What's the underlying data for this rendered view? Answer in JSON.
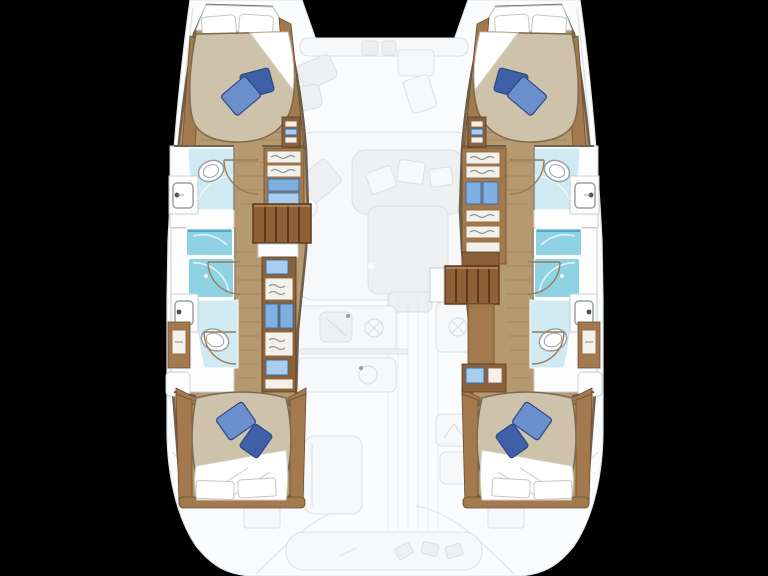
{
  "scene": {
    "description": "Top-down floor plan of a four-cabin sailing catamaran; the two hull interiors are drawn in full colour while the central bridgedeck, foredeck and cockpit are shown faded",
    "background": "#000000",
    "cabins": 4,
    "bathrooms": 4
  },
  "colors": {
    "background": "#000000",
    "deck": "#fbfcfd",
    "deck_line": "#e2e5e8",
    "faded": "#edeff1",
    "faded_stroke": "#dcdfe2",
    "faded_white": "#f7f8fa",
    "wood_floor": "#b7996f",
    "wood_plank": "#a1825b",
    "wood_mid": "#a37a4e",
    "wood_dark": "#8a6138",
    "wood_steps": "#8d6038",
    "step_dark": "#5c3a1c",
    "wall": "#6e604e",
    "bed": "#cec2ab",
    "bed_line": "#7a6a50",
    "pillow_white": "#ffffff",
    "pillow_blue": "#6b90cb",
    "pillow_blue_dark": "#3f5fa6",
    "pillow_edge": "#2c4a86",
    "shower": "#8ed2e4",
    "shower_edge": "#58a7c2",
    "shower_floor": "#cfeaf2",
    "basin_blue": "#7fb0e0",
    "fixture_line": "#9aa0a4"
  },
  "hulls": {
    "port": {
      "label": "Port hull",
      "rooms": [
        {
          "id": "fore-cabin",
          "type": "cabin",
          "features": [
            "double berth",
            "2 white pillows",
            "2 blue cushions",
            "wardrobe shelves"
          ]
        },
        {
          "id": "fore-bathroom",
          "type": "bathroom",
          "features": [
            "washbasin",
            "toilet",
            "shower floor",
            "door"
          ]
        },
        {
          "id": "companionway-steps",
          "type": "stairs",
          "treads": 5
        },
        {
          "id": "aft-bathroom",
          "type": "bathroom",
          "features": [
            "2 shower stalls",
            "washbasin",
            "toilet",
            "drawer cabinet"
          ]
        },
        {
          "id": "aft-cabin",
          "type": "cabin",
          "features": [
            "double berth",
            "2 blue cushions",
            "2 white pillows",
            "side cabinet",
            "night shelf"
          ]
        }
      ]
    },
    "starboard": {
      "label": "Starboard hull",
      "mirrored_from": "port",
      "rooms": [
        {
          "id": "fore-cabin",
          "type": "cabin",
          "features": [
            "double berth",
            "2 white pillows",
            "2 blue cushions",
            "wardrobe shelves"
          ]
        },
        {
          "id": "fore-bathroom",
          "type": "bathroom",
          "features": [
            "washbasin",
            "toilet",
            "shower floor",
            "door"
          ]
        },
        {
          "id": "companionway-steps",
          "type": "stairs",
          "treads": 5
        },
        {
          "id": "aft-bathroom",
          "type": "bathroom",
          "features": [
            "2 shower stalls",
            "washbasin",
            "toilet",
            "drawer cabinet"
          ]
        },
        {
          "id": "aft-cabin",
          "type": "cabin",
          "features": [
            "double berth",
            "2 blue cushions",
            "2 white pillows",
            "side cabinet",
            "night shelf"
          ]
        }
      ]
    }
  },
  "bridgedeck": {
    "label": "Bridgedeck (faded)",
    "foredeck": {
      "label": "Foredeck",
      "features": [
        "trampoline",
        "crossbeam",
        "anchor windlass",
        "sun pads",
        "deck lockers"
      ]
    },
    "saloon": {
      "label": "Saloon",
      "features": [
        "sofa with cushions",
        "dining table",
        "navigation station"
      ]
    },
    "galley": {
      "label": "Galley",
      "features": [
        "sink",
        "hob burners",
        "island worktop with round basin"
      ]
    },
    "cockpit": {
      "label": "Cockpit",
      "features": [
        "forward bench",
        "helm seat",
        "deck hatches",
        "transom bench with cushions"
      ]
    }
  }
}
